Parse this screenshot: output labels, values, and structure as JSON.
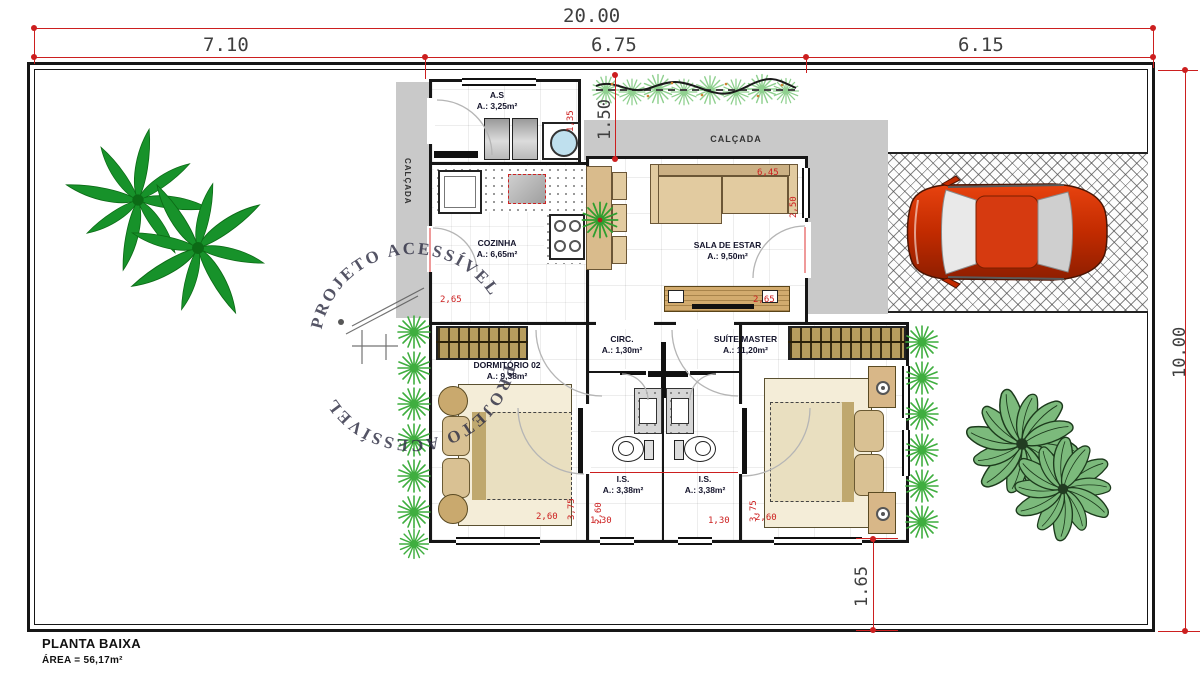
{
  "page": {
    "title": "PLANTA BAIXA",
    "area": "ÁREA = 56,17m²"
  },
  "dims": {
    "total_w": "20.00",
    "seg_left": "7.10",
    "seg_mid": "6.75",
    "seg_right": "6.15",
    "total_h": "10.00",
    "front_setback": "1.50",
    "rear_setback": "1.65"
  },
  "rooms": {
    "servico": {
      "name": "A.S",
      "area": "A.: 3,25m²"
    },
    "cozinha": {
      "name": "COZINHA",
      "area": "A.: 6,65m²"
    },
    "sala": {
      "name": "SALA DE ESTAR",
      "area": "A.: 9,50m²"
    },
    "dormitorio2": {
      "name": "DORMITÓRIO 02",
      "area": "A.: 9,38m²"
    },
    "circulacao": {
      "name": "CIRC.",
      "area": "A.: 1,30m²"
    },
    "suite": {
      "name": "SUÍTE MASTER",
      "area": "A.: 11,20m²"
    },
    "banheiro1": {
      "name": "I.S.",
      "area": "A.: 3,38m²"
    },
    "banheiro2": {
      "name": "I.S.",
      "area": "A.: 3,38m²"
    }
  },
  "labels": {
    "calcada_top": "CALÇADA",
    "calcada_left": "CALÇADA"
  },
  "watermark": {
    "text": "PROJETO ACESSÍVEL"
  },
  "red_dims": {
    "as_h": "1,35",
    "sala_w": "6,45",
    "sala_door": "2,50",
    "cozinha_w": "2,65",
    "sala_tv": "2,65",
    "dorm_w": "2,60",
    "dorm_h": "3,75",
    "bath1_h": "2,60",
    "bath1_w": "1,30",
    "bath2_w": "1,30",
    "suite_h": "3,75",
    "suite_w": "2,60"
  },
  "colors": {
    "dim_gray": "#3f3f3f",
    "dim_red": "#cc1f1f",
    "wall": "#161616",
    "calcada": "#c9c9c9",
    "furniture_tan": "#e2cba0",
    "wardrobe": "#b79d5e",
    "plant": "#3fae3f",
    "palm": "#17922a",
    "car": "#cc2b00"
  }
}
